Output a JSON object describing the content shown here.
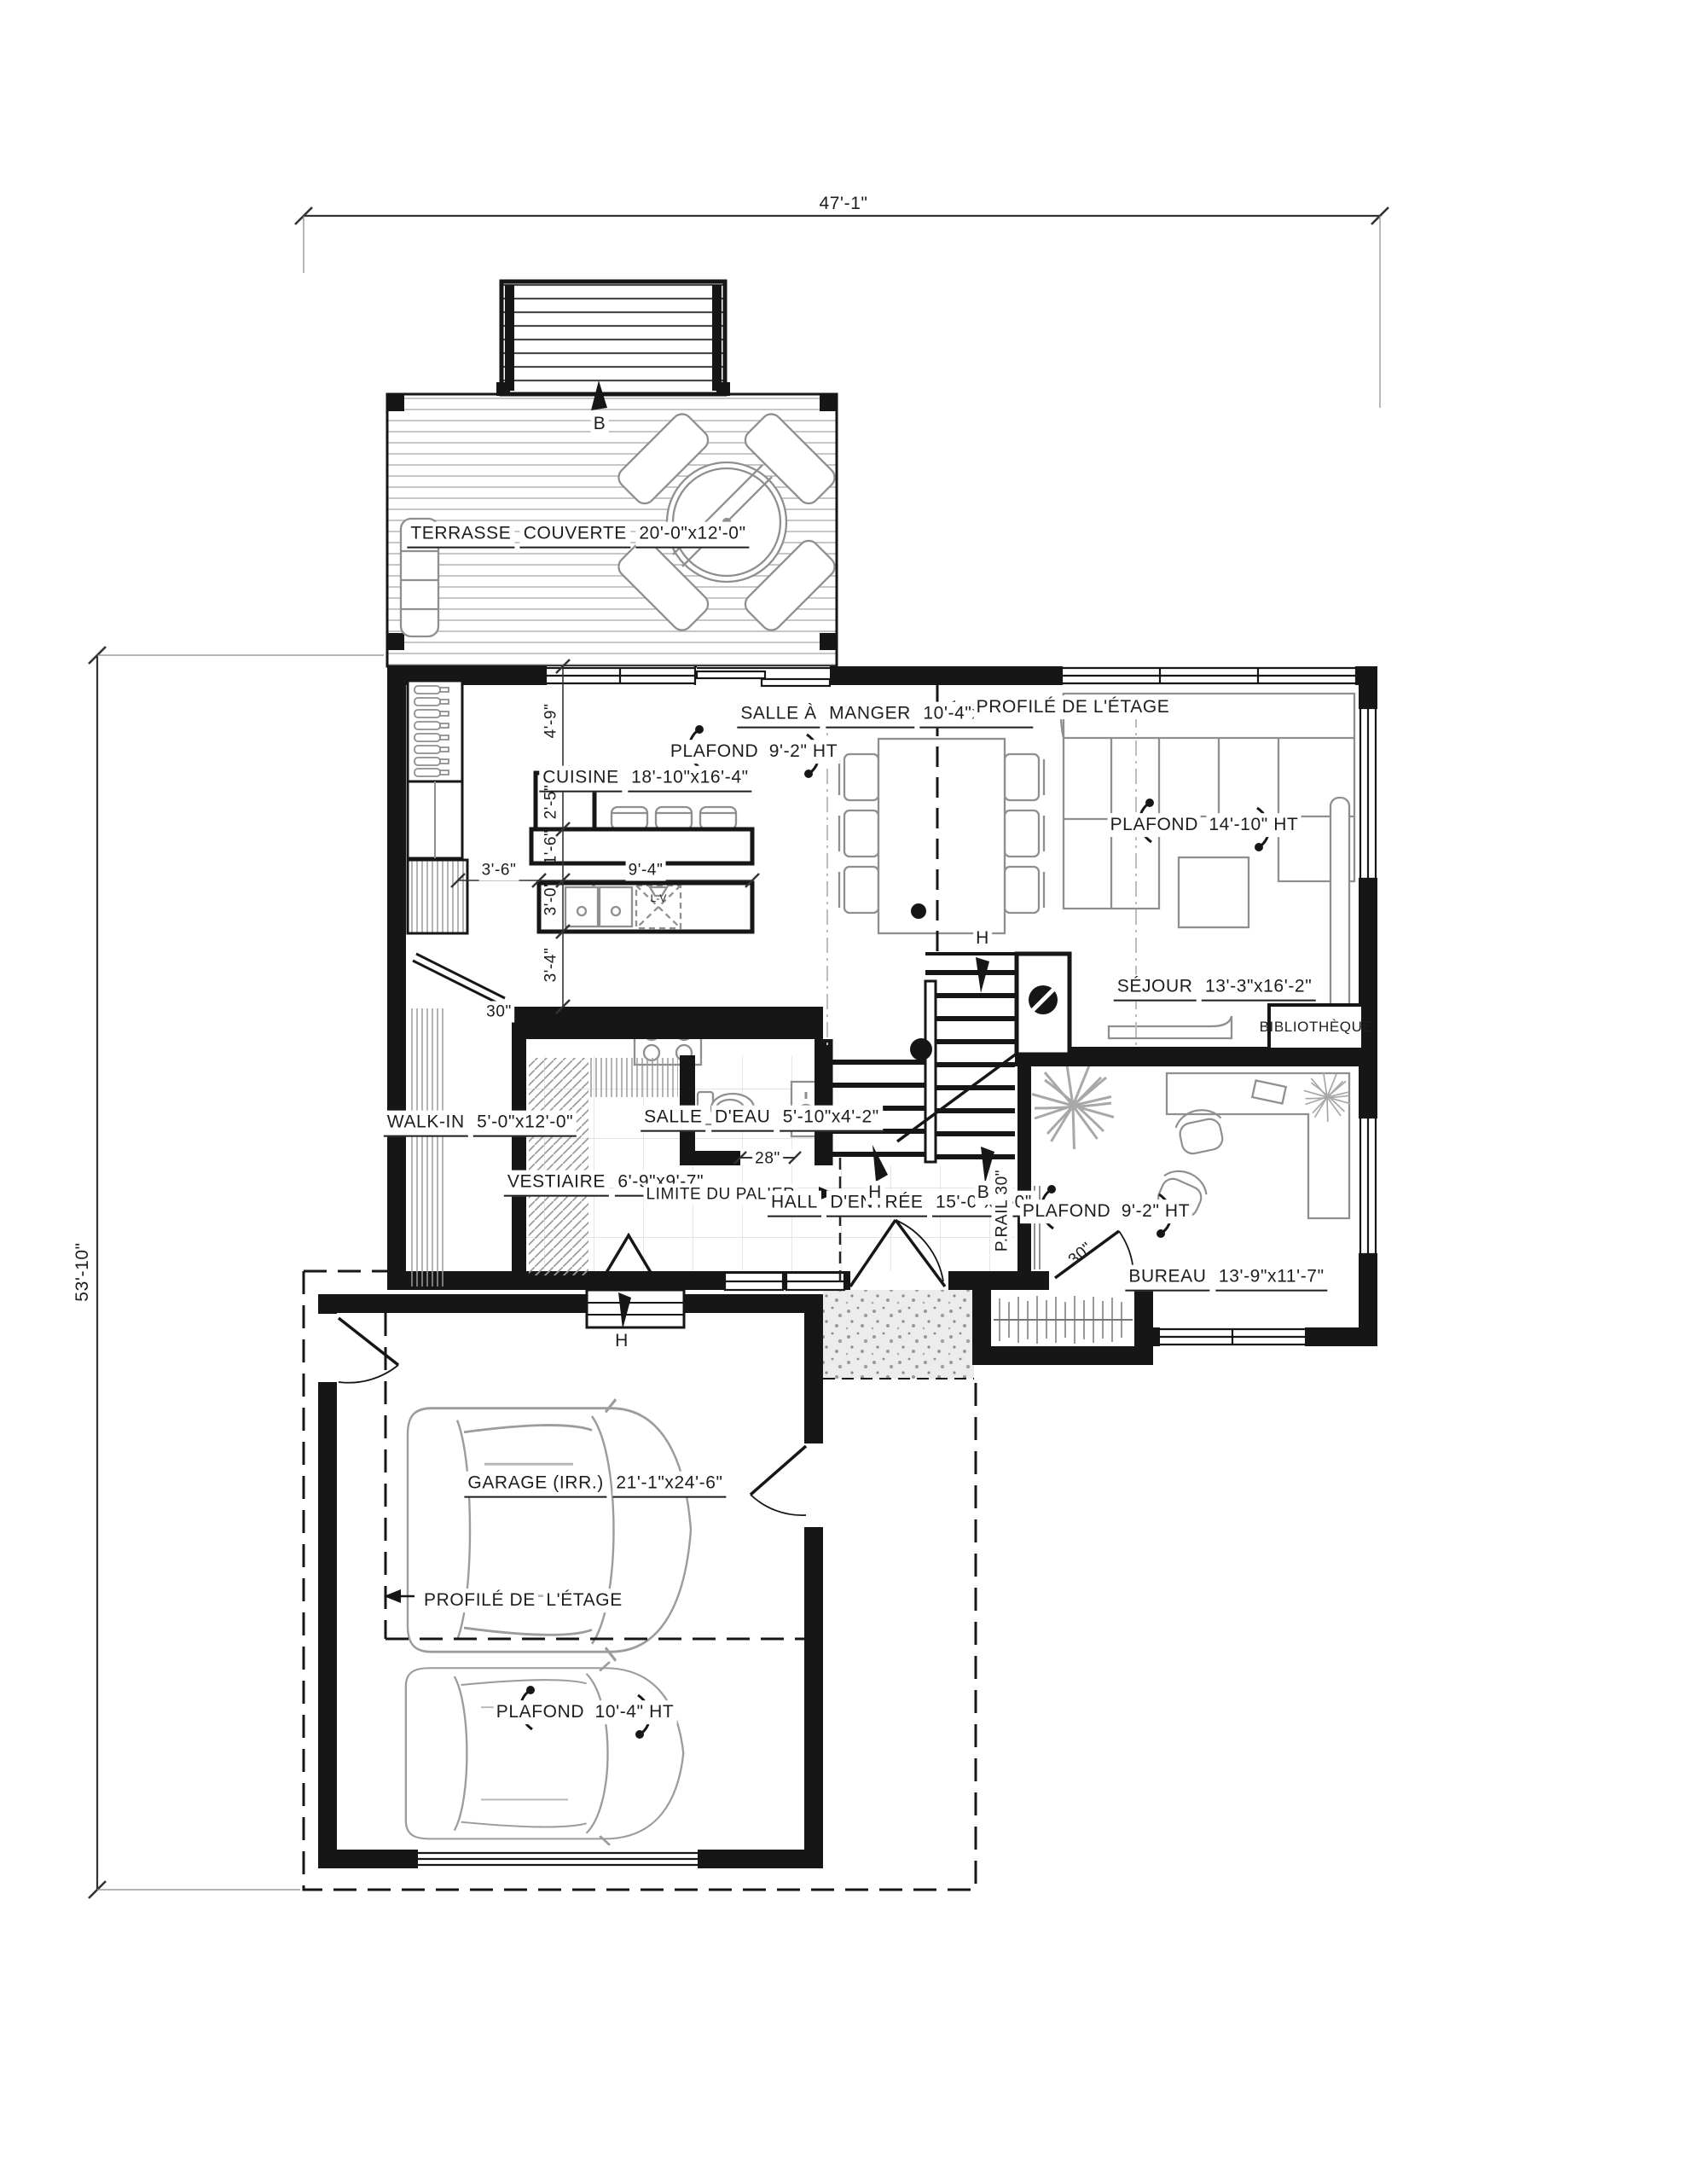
{
  "drawing": {
    "type": "architectural-floor-plan",
    "overall": {
      "width_dim": "47'-1\"",
      "height_dim": "53'-10\""
    },
    "rooms": {
      "terrasse": {
        "l1": "TERRASSE",
        "l2": "COUVERTE",
        "l3": "20'-0\"x12'-0\""
      },
      "cuisine": {
        "l1": "CUISINE",
        "l2": "18'-10\"x16'-4\""
      },
      "salle_a_manger": {
        "l1": "SALLE À",
        "l2": "MANGER",
        "l3": "10'-4\"x13'-4\""
      },
      "sejour": {
        "l1": "SÉJOUR",
        "l2": "13'-3\"x16'-2\""
      },
      "walk_in": {
        "l1": "WALK-IN",
        "l2": "5'-0\"x12'-0\""
      },
      "vestiaire": {
        "l1": "VESTIAIRE",
        "l2": "6'-9\"x9'-7\""
      },
      "salle_eau": {
        "l1": "SALLE",
        "l2": "D'EAU",
        "l3": "5'-10\"x4'-2\""
      },
      "hall": {
        "l1": "HALL",
        "l2": "D'ENTRÉE",
        "l3": "15'-0\"x5'-0\""
      },
      "bureau": {
        "l1": "BUREAU",
        "l2": "13'-9\"x11'-7\""
      },
      "garage": {
        "l1": "GARAGE (IRR.)",
        "l2": "21'-1\"x24'-6\""
      },
      "bibliotheque": "BIBLIOTHÈQUE"
    },
    "ceilings": {
      "cuisine": {
        "l1": "PLAFOND",
        "l2": "9'-2\" HT"
      },
      "sejour": {
        "l1": "PLAFOND",
        "l2": "14'-10\" HT"
      },
      "bureau": {
        "l1": "PLAFOND",
        "l2": "9'-2\" HT"
      },
      "garage": {
        "l1": "PLAFOND",
        "l2": "10'-4\" HT"
      }
    },
    "annotations": {
      "profile_etage_main": "PROFILÉ DE L'ÉTAGE",
      "profile_etage_garage": {
        "l1": "PROFILÉ DE",
        "l2": "L'ÉTAGE"
      },
      "limite_palier": "LIMITE DU PALIER",
      "prail": "P.RAIL 30\"",
      "lave_vaisselle": "L-V"
    },
    "dims": {
      "d49": "4'-9\"",
      "d25": "2'-5\"",
      "d16": "1'-6\"",
      "d30": "3'-0\"",
      "d34": "3'-4\"",
      "d36": "3'-6\"",
      "d94": "9'-4\"",
      "d28": "28\"",
      "door_kitchen": "30\"",
      "door_bureau": "30\""
    },
    "stairs": {
      "h_top": "H",
      "h_bottom": "H",
      "b_bottom": "B",
      "b_deck": "B",
      "h_garage_steps": "H"
    }
  }
}
